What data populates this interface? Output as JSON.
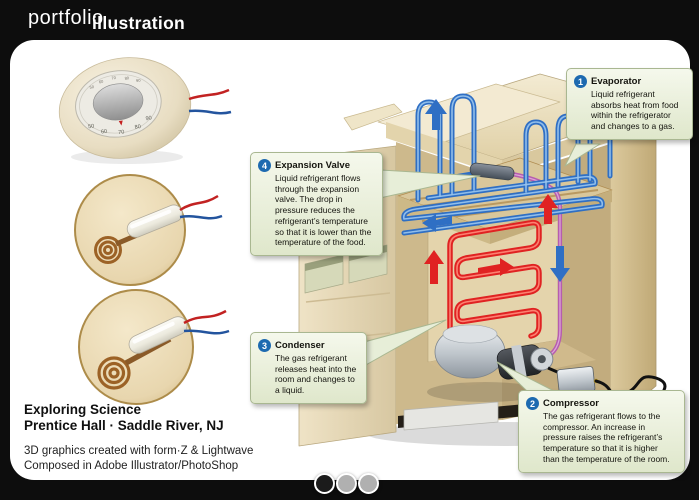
{
  "header": {
    "brand_light": "portfolio",
    "brand_bold": "illustration"
  },
  "thumbnails": [
    {
      "name": "round-thermostat",
      "dial_numbers": [
        "50",
        "60",
        "70",
        "80",
        "90"
      ]
    },
    {
      "name": "mercury-switch-with-coil-tight"
    },
    {
      "name": "mercury-switch-with-coil-open"
    }
  ],
  "callouts": [
    {
      "number": "1",
      "title": "Evaporator",
      "body": "Liquid refrigerant absorbs heat from food within the refrigerator and changes to a gas."
    },
    {
      "number": "2",
      "title": "Compressor",
      "body": "The gas refrigerant flows to the compressor. An increase in pressure raises the refrigerant’s temperature so that it is higher than the temperature of the room."
    },
    {
      "number": "3",
      "title": "Condenser",
      "body": "The gas refrigerant releases heat into the room and changes to a liquid."
    },
    {
      "number": "4",
      "title": "Expansion Valve",
      "body": "Liquid refrigerant flows through the expansion valve. The drop in pressure reduces the refrigerant’s temperature so that it is lower than the temperature of the food."
    }
  ],
  "credits": {
    "client_line1": "Exploring Science",
    "client_line2": "Prentice Hall · Saddle River, NJ",
    "tools_line1": "3D graphics created with form·Z & Lightwave",
    "tools_line2": "Composed in Adobe Illustrator/PhotoShop"
  },
  "pagination": {
    "dot_count": 3,
    "active_index": 0
  },
  "colors": {
    "page_bg": "#0d0d0d",
    "panel_bg": "#ffffff",
    "badge_blue": "#1d6ab0",
    "callout_bg": "#e9efd9",
    "callout_border": "#a9b791",
    "evaporator_blue": "#2f6fc4",
    "condenser_red": "#e02222",
    "tube_purple": "#b65cb0",
    "fridge_cream": "#e9ddb9",
    "dial_cream": "#ece4cf"
  }
}
